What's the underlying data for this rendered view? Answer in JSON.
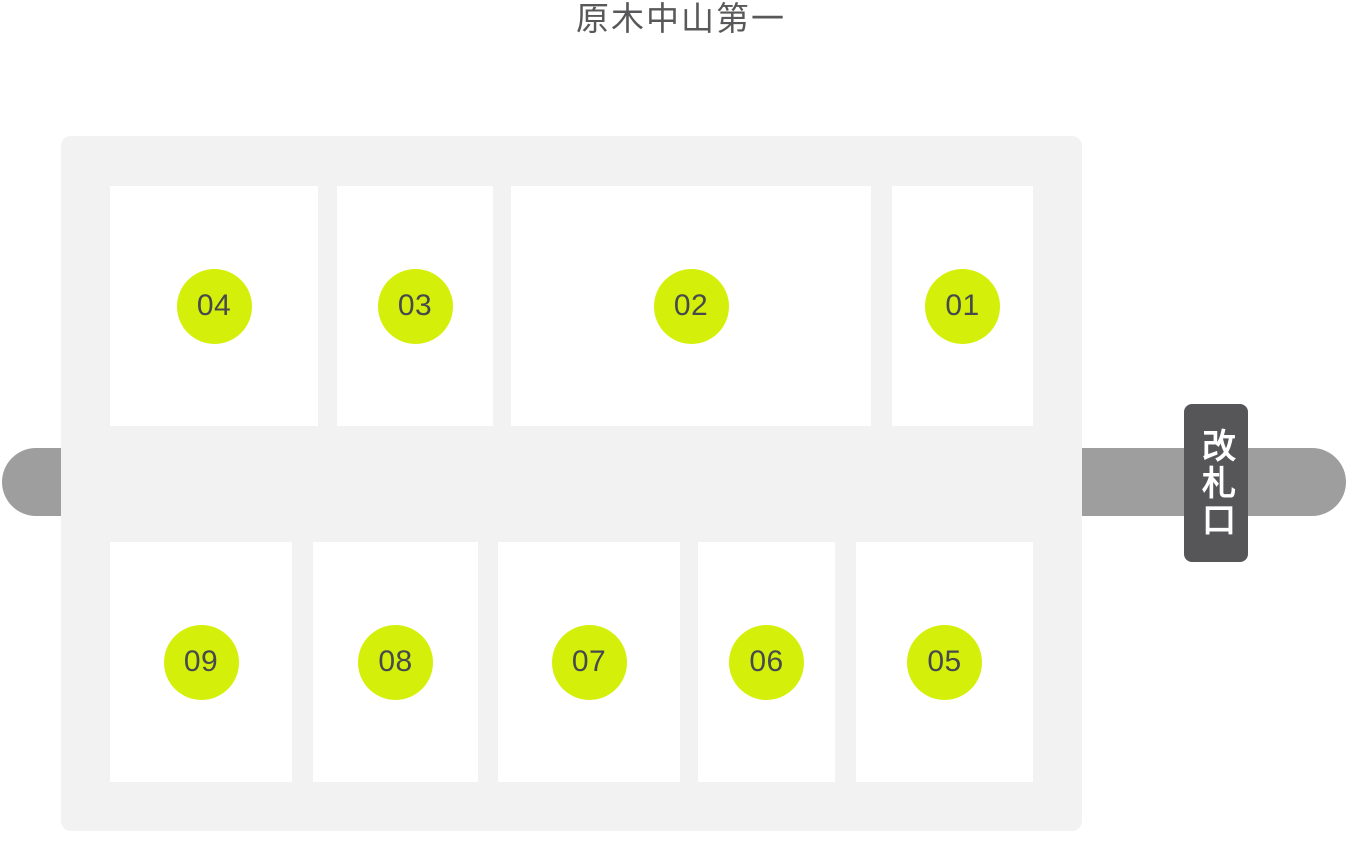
{
  "title": "原木中山第一",
  "gate": {
    "label": "改札口"
  },
  "zones": {
    "top": [
      "04",
      "03",
      "02",
      "01"
    ],
    "bottom": [
      "09",
      "08",
      "07",
      "06",
      "05"
    ]
  },
  "colors": {
    "background": "#ffffff",
    "title_text": "#58585a",
    "panel": "#f2f2f2",
    "zone_box": "#ffffff",
    "zone_badge": "#d4f00a",
    "zone_number": "#474a4d",
    "corridor_bar": "#9e9e9e",
    "gate_bg": "#565659",
    "gate_text": "#ffffff"
  }
}
